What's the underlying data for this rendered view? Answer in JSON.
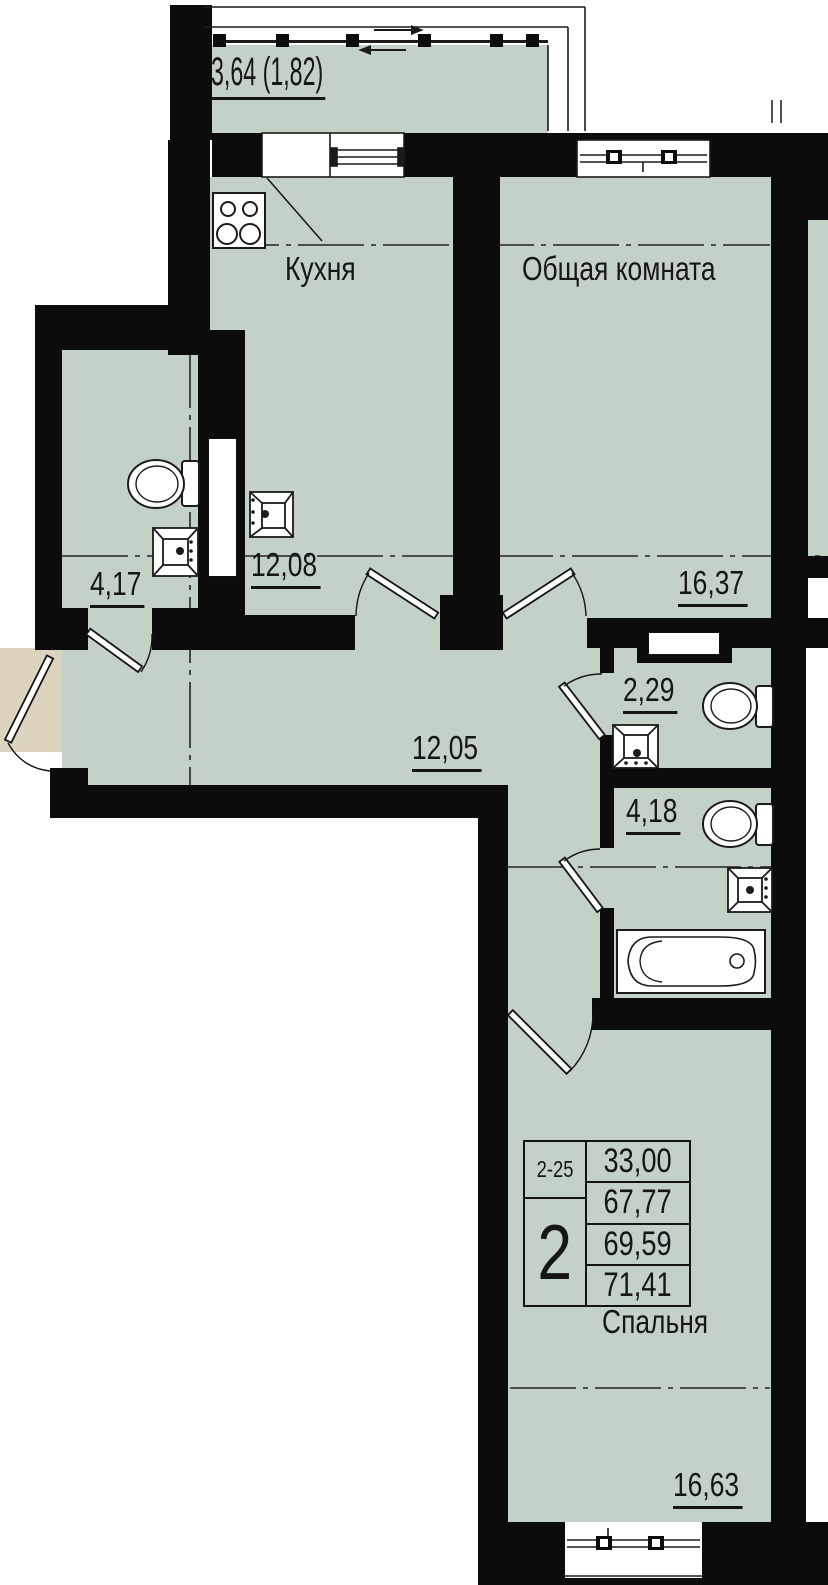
{
  "plan": {
    "balcony": {
      "area_label": "3,64 (1,82)"
    },
    "rooms": {
      "kitchen": {
        "name": "Кухня",
        "area": "12,08"
      },
      "living": {
        "name": "Общая комната",
        "area": "16,37"
      },
      "bath_small": {
        "area": "4,17"
      },
      "hall": {
        "area": "12,05"
      },
      "wc": {
        "area": "2,29"
      },
      "bath": {
        "area": "4,18"
      },
      "bedroom": {
        "name": "Спальня",
        "area": "16,63"
      }
    },
    "info_table": {
      "floors_range": "2-25",
      "room_count": "2",
      "values": [
        "33,00",
        "67,77",
        "69,59",
        "71,41"
      ]
    },
    "colors": {
      "room_fill": "#c4d1c7",
      "wall": "#0c0c0c",
      "entry_landing": "#ddd4bf",
      "outside": "#ffffff"
    },
    "icons": [
      "stove-icon",
      "kitchen-sink-icon",
      "toilet-icon",
      "washbasin-icon",
      "bathtub-icon",
      "door-leaf-icon",
      "window-icon",
      "vent-shaft-icon"
    ]
  }
}
